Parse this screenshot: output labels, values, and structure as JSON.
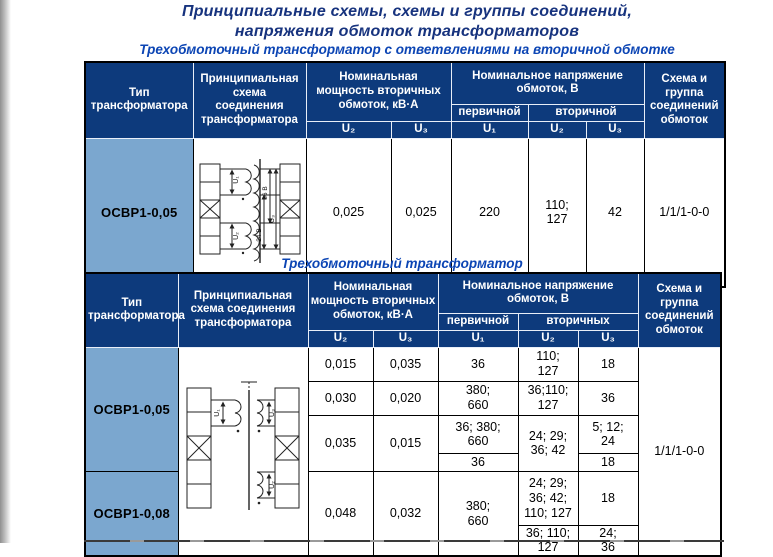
{
  "page": {
    "title_line1": "Принципиальные схемы, схемы и группы соединений,",
    "title_line2": "напряжения обмоток трансформаторов",
    "table1_caption": "Трехобмоточный трансформатор с ответвлениями на вторичной обмотке",
    "table2_caption": "Трехобмоточный трансформатор"
  },
  "colors": {
    "header_bg": "#0d3a7c",
    "type_cell_bg": "#7ba7cf",
    "title_text": "#17337e",
    "caption_text": "#0c45b4",
    "table_border": "#000000"
  },
  "table1": {
    "header": {
      "type": "Тип\nтрансформатора",
      "scheme": "Принципиальная\nсхема\nсоединения\nтрансформатора",
      "power_group": "Номинальная\nмощность вторичных\nобмоток, кВ·А",
      "voltage_group": "Номинальное напряжение\nобмоток, В",
      "primary": "первичной",
      "secondary": "вторичной",
      "group": "Схема и\nгруппа\nсоединений\nобмоток",
      "u1": "U₁",
      "u2": "U₂",
      "u3": "U₃"
    },
    "row": {
      "type": "ОСВР1-0,05",
      "p_u2": "0,025",
      "p_u3": "0,025",
      "v_u1": "220",
      "v_u2": "110;\n127",
      "v_u3": "42",
      "group": "1/1/1-0-0"
    },
    "schematic": {
      "u1": "U₁",
      "u2": "U₂",
      "u3": "U₃",
      "v36": "36 В",
      "v24": "24 В"
    }
  },
  "table2": {
    "header": {
      "type": "Тип\nтрансформатора",
      "scheme": "Принципиальная\nсхема соединения\nтрансформатора",
      "power_group": "Номинальная\nмощность вторичных\nобмоток, кВ·А",
      "voltage_group": "Номинальное напряжение\nобмоток, В",
      "primary": "первичной",
      "secondary": "вторичных",
      "group": "Схема и\nгруппа\nсоединений\nобмоток",
      "u1": "U₁",
      "u2": "U₂",
      "u3": "U₃"
    },
    "types": {
      "t1": "ОСВР1-0,05",
      "t2": "ОСВР1-0,08"
    },
    "group": "1/1/1-0-0",
    "rows": {
      "r1": {
        "p_u2": "0,015",
        "p_u3": "0,035",
        "v_u1": "36",
        "v_u2": "110;\n127",
        "v_u3": "18"
      },
      "r2": {
        "p_u2": "0,030",
        "p_u3": "0,020",
        "v_u1": "380;\n660",
        "v_u2": "36;110;\n127",
        "v_u3": "36"
      },
      "r3": {
        "p_u2": "0,035",
        "p_u3": "0,015",
        "v_u1a": "36; 380;\n660",
        "v_u1b": "36",
        "v_u2": "24; 29;\n36; 42",
        "v_u3a": "5; 12;\n24",
        "v_u3b": "18"
      },
      "r4": {
        "p_u2": "0,048",
        "p_u3": "0,032",
        "v_u1": "380;\n660",
        "v_u2a": "24; 29;\n36; 42;\n110; 127",
        "v_u3a": "18",
        "v_u2b": "36; 110;\n127",
        "v_u3b": "24;\n36"
      }
    },
    "schematic": {
      "u1": "U₁",
      "u2": "U₂",
      "u3": "U₃"
    }
  }
}
